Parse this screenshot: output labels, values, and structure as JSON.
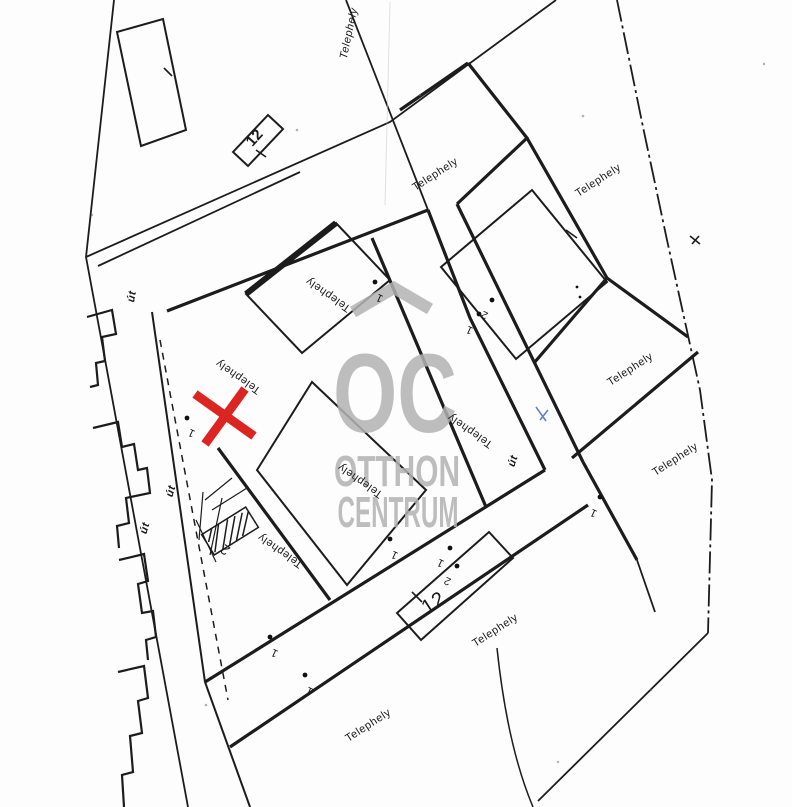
{
  "watermark": {
    "logo_text": "OC",
    "name_line1": "OTTHON",
    "name_line2": "CENTRUM"
  },
  "map": {
    "colors": {
      "line": "#1c1c1c",
      "red_x": "#dc2420",
      "watermark_gray": "#b3b3b3",
      "blue_mark": "#4060c2",
      "paper": "#fdfdfd"
    },
    "parcel_labels": [
      {
        "text": "Telephely",
        "transform": "translate(352 34) rotate(-78)"
      },
      {
        "text": "Telephely",
        "transform": "translate(600 183) rotate(-33)"
      },
      {
        "text": "Telephely",
        "transform": "translate(437 177) rotate(-33)"
      },
      {
        "text": "Telephely",
        "transform": "translate(632 372) rotate(-33)"
      },
      {
        "text": "Telephely",
        "transform": "translate(677 462) rotate(-33)"
      },
      {
        "text": "Telephely",
        "transform": "translate(497 633) rotate(-33)"
      },
      {
        "text": "Telephely",
        "transform": "translate(370 728) rotate(-33)"
      },
      {
        "text": "Telephely",
        "transform": "translate(240 374) rotate(215)"
      },
      {
        "text": "Telephely",
        "transform": "translate(330 292) rotate(215)"
      },
      {
        "text": "Telephely",
        "transform": "translate(362 478) rotate(215)"
      },
      {
        "text": "Telephely",
        "transform": "translate(472 428) rotate(215)"
      },
      {
        "text": "Telephely",
        "transform": "translate(282 548) rotate(215)"
      }
    ],
    "road_labels": [
      {
        "text": "út",
        "transform": "translate(135 297) rotate(-80)"
      },
      {
        "text": "út",
        "transform": "translate(174 492) rotate(-74)"
      },
      {
        "text": "út",
        "transform": "translate(148 529) rotate(-74)"
      },
      {
        "text": "út",
        "transform": "translate(516 462) rotate(-72)"
      }
    ],
    "plot_numbers": [
      {
        "text": "12",
        "transform": "translate(258 141) rotate(-48)"
      },
      {
        "text": "12",
        "transform": "translate(437 608) rotate(-33)"
      }
    ],
    "point_markers": [
      {
        "text": "1",
        "transform": "translate(193 430) rotate(205)"
      },
      {
        "text": "1",
        "transform": "translate(381 295) rotate(205)"
      },
      {
        "text": "2",
        "transform": "translate(228 546) rotate(215)"
      },
      {
        "text": "1",
        "transform": "translate(396 552) rotate(205)"
      },
      {
        "text": "1",
        "transform": "translate(442 560) rotate(205)"
      },
      {
        "text": "2",
        "transform": "translate(449 578) rotate(205)"
      },
      {
        "text": "1",
        "transform": "translate(276 650) rotate(205)"
      },
      {
        "text": "1",
        "transform": "translate(311 688) rotate(205)"
      },
      {
        "text": "1",
        "transform": "translate(471 327) rotate(205)"
      },
      {
        "text": "2",
        "transform": "translate(486 312) rotate(205)"
      },
      {
        "text": "1",
        "transform": "translate(595 510) rotate(205)"
      }
    ]
  }
}
